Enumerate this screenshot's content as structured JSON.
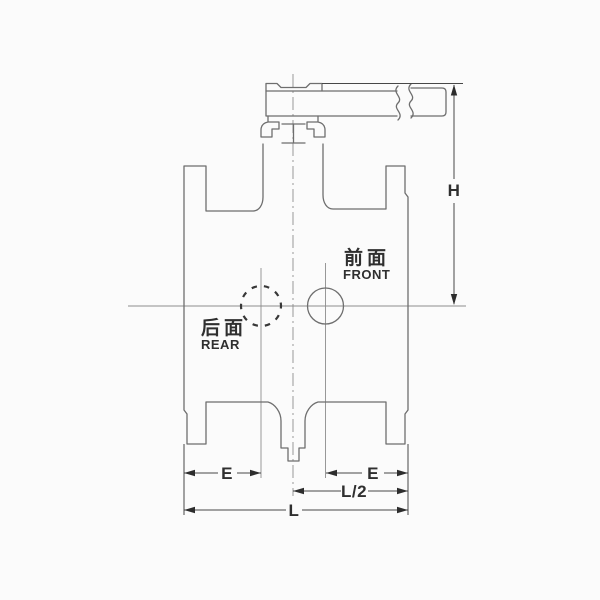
{
  "labels": {
    "front_zh": "前面",
    "front_en": "FRONT",
    "rear_zh": "后面",
    "rear_en": "REAR"
  },
  "dimensions": {
    "height": "H",
    "e_left": "E",
    "e_right": "E",
    "half_length": "L/2",
    "length": "L"
  },
  "colors": {
    "background": "#fbfbfb",
    "outline": "#6e6e6e",
    "dimension": "#474747",
    "arrow": "#2d2d2d",
    "text": "#2f2f2f",
    "centerline": "#8d8d8d"
  }
}
